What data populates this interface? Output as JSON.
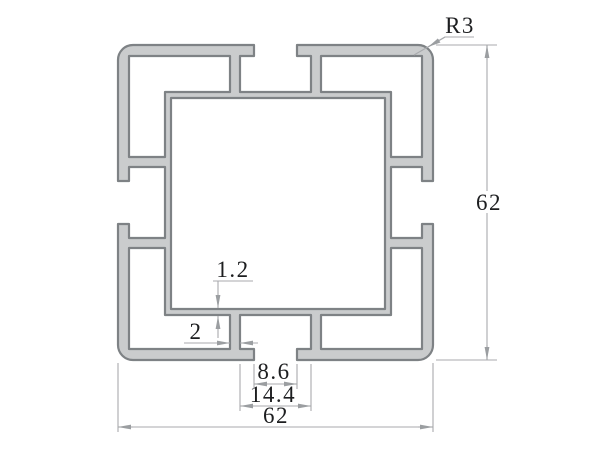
{
  "drawing": {
    "type": "technical-cross-section",
    "subject": "t-slot-extrusion-profile",
    "dimensions": {
      "corner_radius": {
        "label": "R3"
      },
      "overall_height": {
        "label": "62"
      },
      "overall_width": {
        "label": "62"
      },
      "wall_thickness": {
        "label": "1.2"
      },
      "rib_thickness": {
        "label": "2"
      },
      "slot_opening": {
        "label": "8.6"
      },
      "slot_inner_width": {
        "label": "14.4"
      }
    },
    "colors": {
      "background": "#ffffff",
      "profile_fill": "#cacccd",
      "profile_stroke": "#7e8285",
      "dimension_line": "#a8aaad",
      "arrow": "#9b9ea1",
      "text": "#1d1e20"
    }
  }
}
